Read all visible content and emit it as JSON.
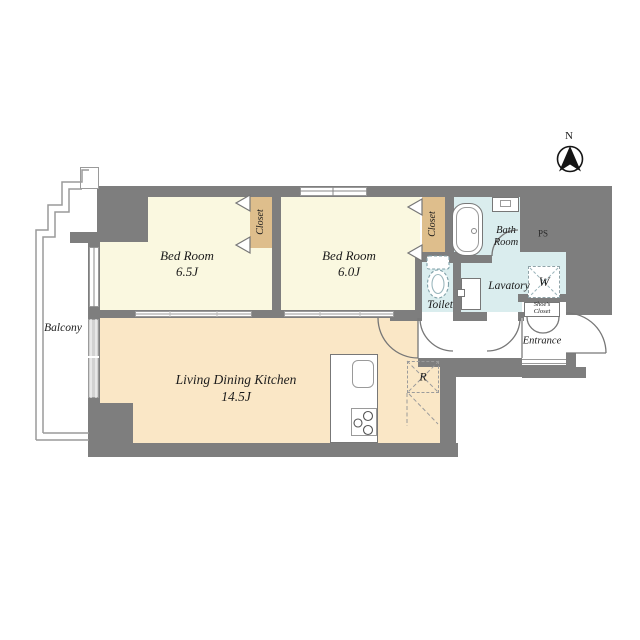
{
  "compass": {
    "north_label": "N"
  },
  "rooms": {
    "bedroom1": {
      "name": "Bed Room",
      "size": "6.5J"
    },
    "bedroom2": {
      "name": "Bed Room",
      "size": "6.0J"
    },
    "ldk": {
      "name": "Living Dining Kitchen",
      "size": "14.5J"
    },
    "bath": {
      "name_line1": "Bath",
      "name_line2": "Room"
    },
    "toilet": {
      "name": "Toilet"
    },
    "lavatory": {
      "name": "Lavatory"
    },
    "entrance": {
      "name": "Entrance"
    },
    "balcony": {
      "name": "Balcony"
    },
    "closet_bedroom1": {
      "name": "Closet"
    },
    "closet_bedroom2": {
      "name": "Closet"
    },
    "shoes_closet": {
      "name_line1": "Shoe's",
      "name_line2": "Closet"
    }
  },
  "fixtures": {
    "washing_machine_label": "W",
    "refrigerator_label": "R",
    "pipe_space_label": "PS"
  },
  "colors": {
    "wall": "#7e7e7e",
    "bedroom_floor": "#faf8e0",
    "ldk_floor": "#fae7c6",
    "closet_floor": "#debe8c",
    "wet_area_floor": "#daedee",
    "balcony_line": "#9a9a9a"
  }
}
